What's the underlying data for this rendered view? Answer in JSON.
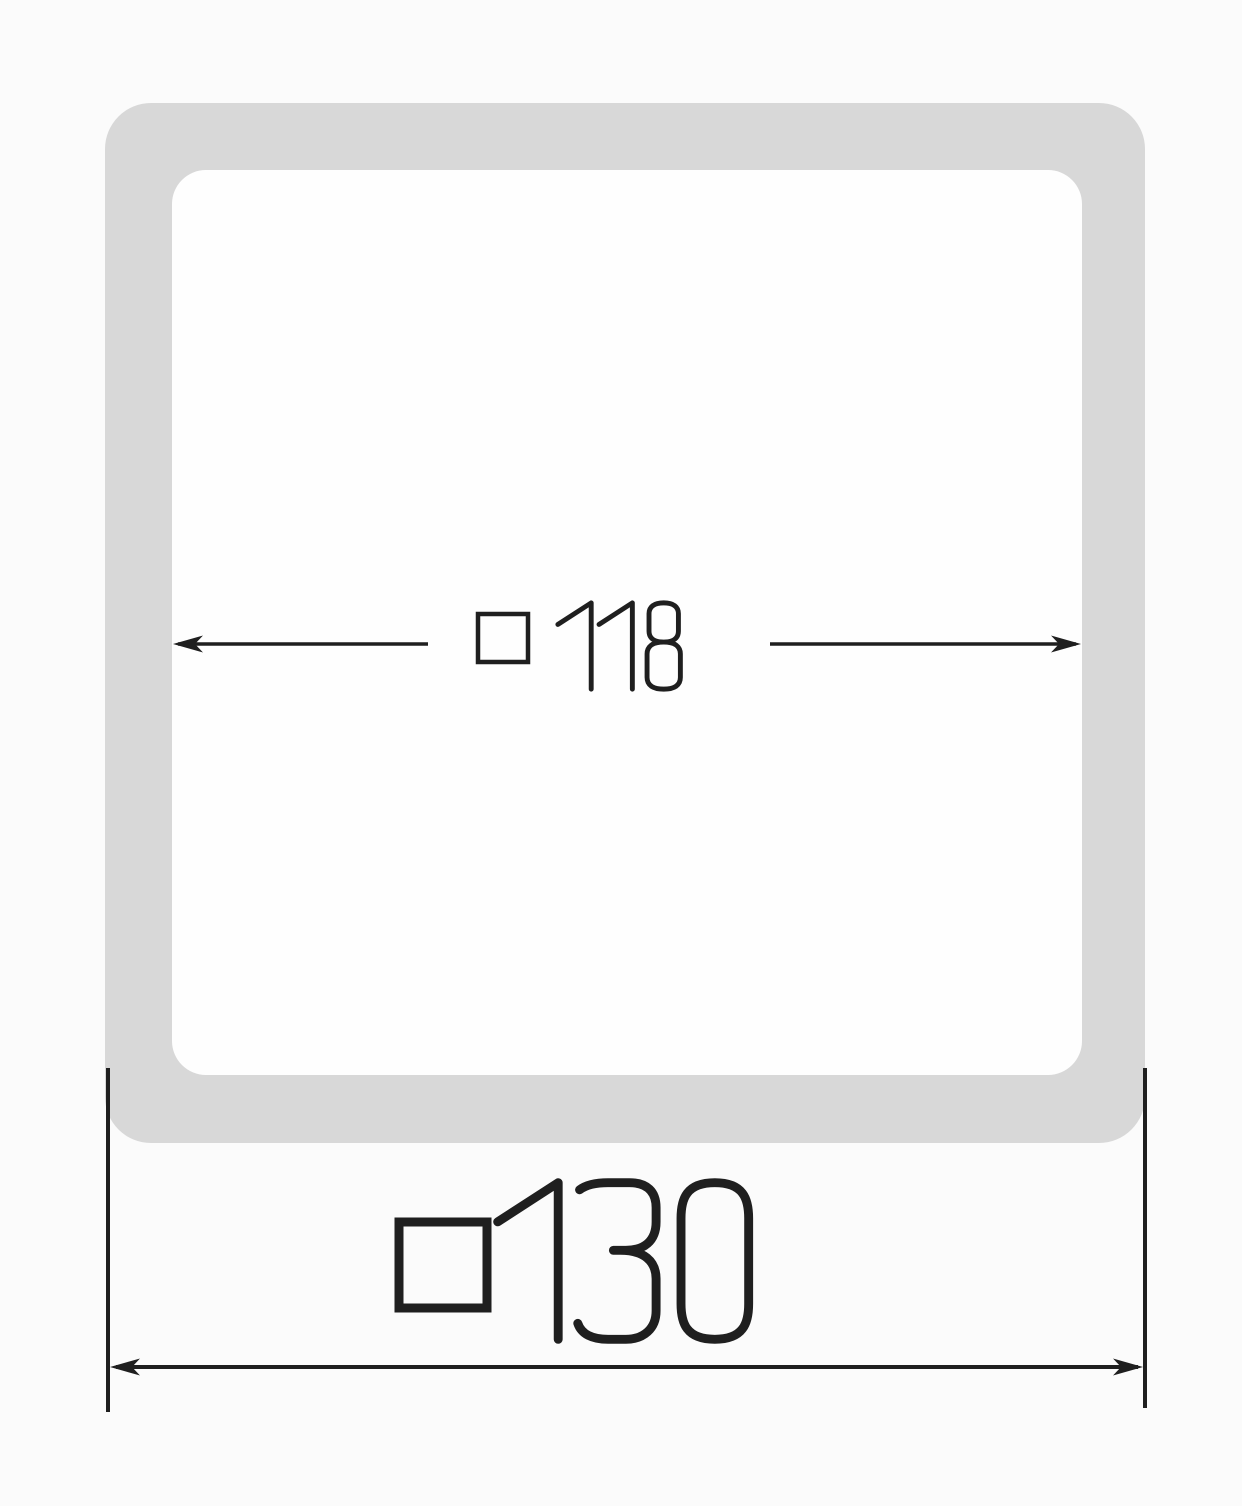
{
  "drawing": {
    "background_color": "#fbfbfb",
    "frame_color": "#d8d8d8",
    "inner_fill_color": "#fefefe",
    "line_color": "#1f1f1f",
    "inner_dimension": {
      "symbol": "□",
      "value": "118",
      "label": "□ 118"
    },
    "outer_dimension": {
      "symbol": "□",
      "value": "130",
      "label": "□ 130"
    }
  }
}
